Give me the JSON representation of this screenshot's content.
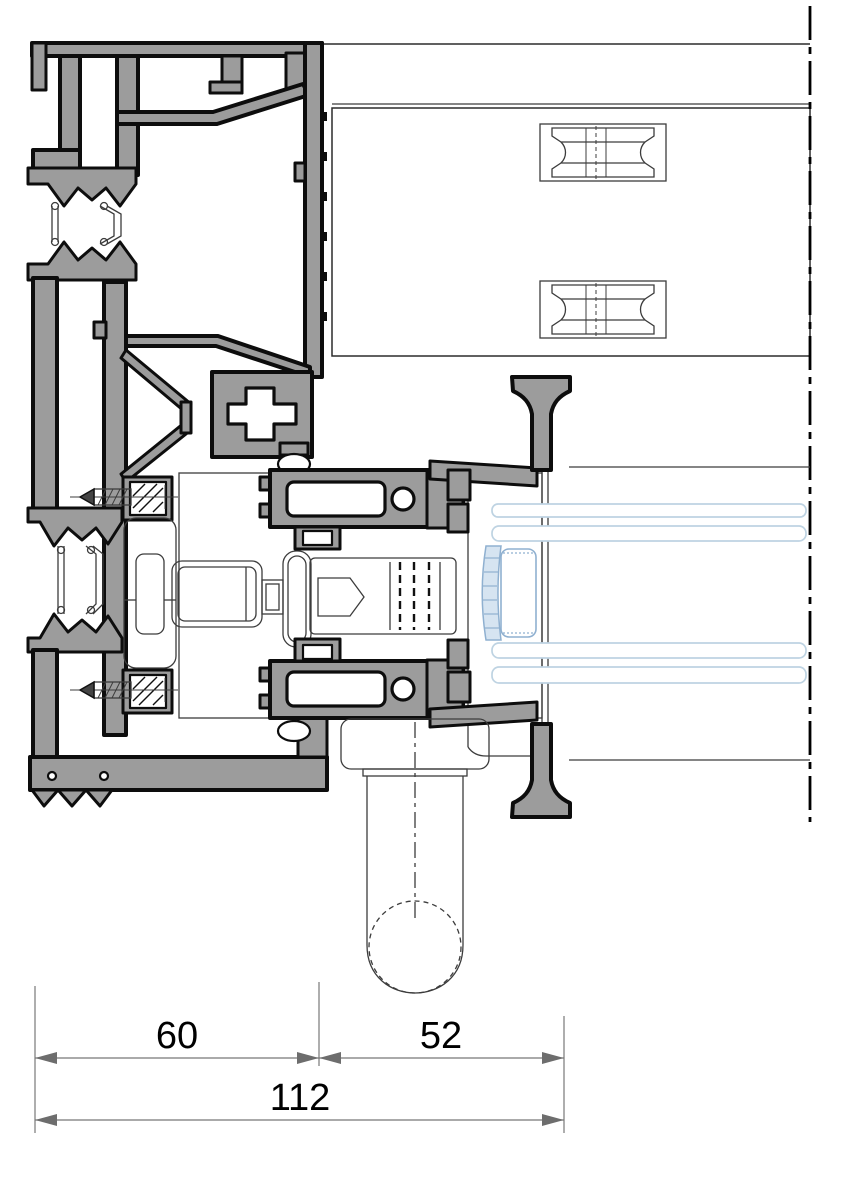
{
  "drawing": {
    "dimensions": {
      "segment_left": {
        "label": "60"
      },
      "segment_right": {
        "label": "52"
      },
      "total": {
        "label": "112"
      }
    },
    "colors": {
      "background": "#ffffff",
      "profile_fill": "#9c9c9c",
      "outline": "#0d0d0d",
      "thin_line": "#3c3c3c",
      "glass_line": "#bed3e2",
      "spacer_fill": "#d6e4f1",
      "spacer_stroke": "#8fb0d0",
      "dimension_line": "#787878",
      "dimension_arrow": "#6d6d6d",
      "dimension_text": "#000000"
    }
  }
}
